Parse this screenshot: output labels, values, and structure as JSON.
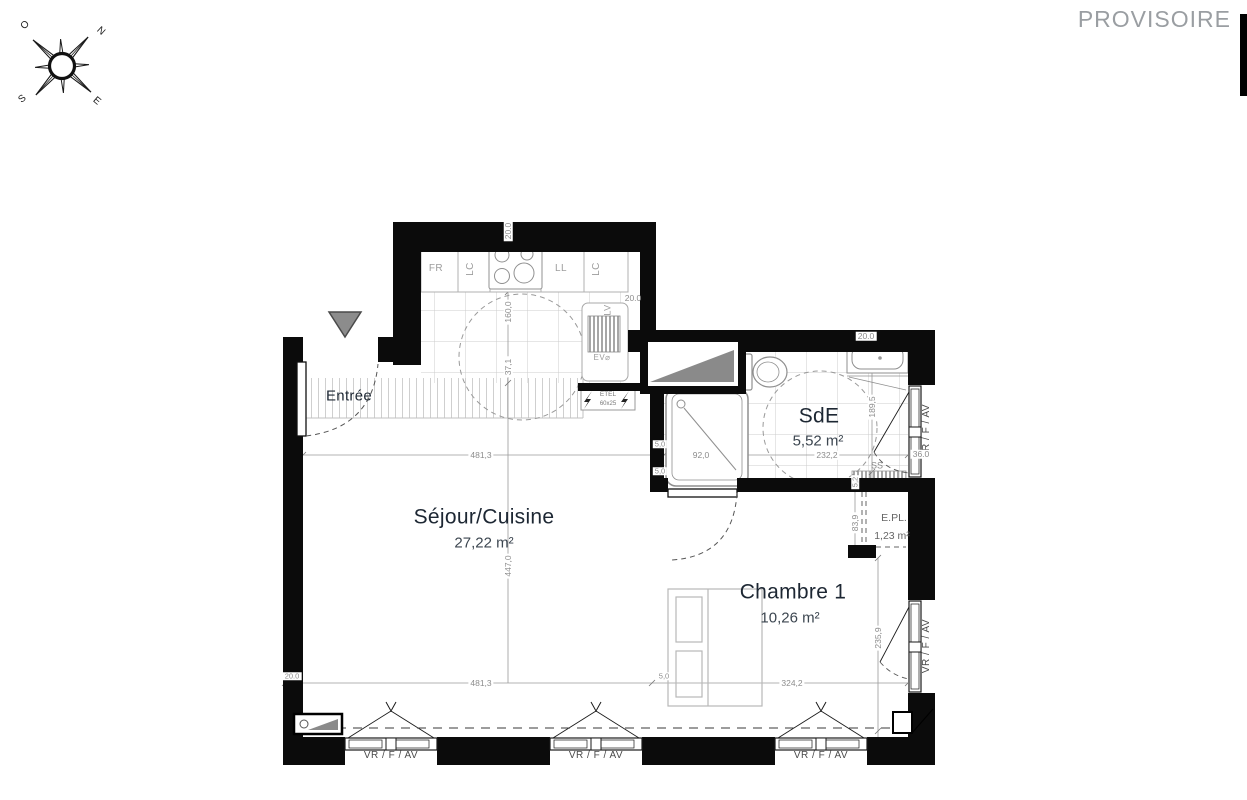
{
  "watermark": "PROVISOIRE",
  "compass": {
    "north": "N",
    "south": "S",
    "east": "E",
    "west": "O"
  },
  "rooms": {
    "entree": {
      "name": "Entrée"
    },
    "sejour": {
      "name": "Séjour/Cuisine",
      "area": "27,22 m²"
    },
    "chambre": {
      "name": "Chambre 1",
      "area": "10,26 m²"
    },
    "sde": {
      "name": "SdE",
      "area": "5,52 m²"
    },
    "placard": {
      "name": "E.PL.",
      "area": "1,23 m²"
    }
  },
  "kitchen": {
    "fridge": "FR",
    "cabinet": "LC",
    "washer": "LL",
    "dishwasher": "LV",
    "sink": "EV⌀",
    "electrical": {
      "name": "ETEL",
      "size": "60x25"
    }
  },
  "bathroom": {
    "towel_dryer": "SS"
  },
  "window_label": "VR / F / AV",
  "dimensions": {
    "wall_top": "20.0",
    "kitchen_width": "160,0",
    "kitchen_offset": "37,1",
    "wall_right_kitchen": "20.0",
    "wall_top_right": "20.0",
    "sejour_width": "481,3",
    "shower_width": "92,0",
    "sde_width": "232,2",
    "sde_height": "189,5",
    "window_recess": "36.0",
    "partition_a": "5,0",
    "partition_b": "5,0",
    "epl_wall": "5,2",
    "epl_height": "83,9",
    "sejour_height": "447,0",
    "chambre_height": "235,9",
    "sejour_width_b": "481,3",
    "chambre_width": "324,2",
    "wall_left": "20.0",
    "partition_c": "5,0"
  }
}
